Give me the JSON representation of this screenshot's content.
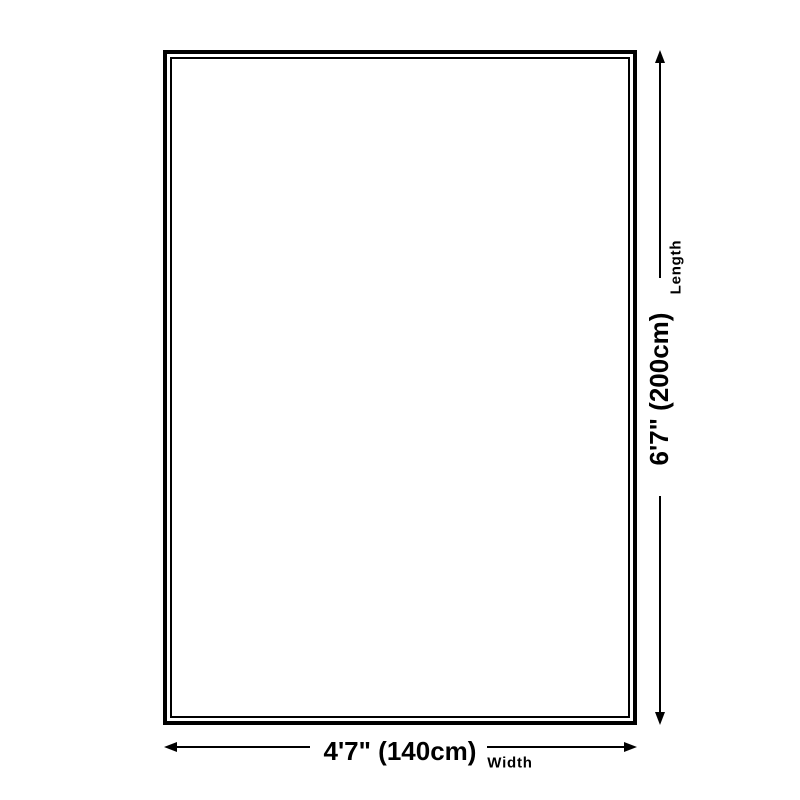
{
  "page": {
    "background_color": "#ffffff",
    "line_color": "#000000"
  },
  "diagram": {
    "type": "product-dimension-diagram",
    "shape": "rectangle-double-outline",
    "length_dimension": {
      "value": "6'7\" (200cm)",
      "axis_label": "Length",
      "orientation": "vertical",
      "side": "right"
    },
    "width_dimension": {
      "value": "4'7\" (140cm)",
      "axis_label": "Width",
      "orientation": "horizontal",
      "side": "bottom"
    }
  }
}
